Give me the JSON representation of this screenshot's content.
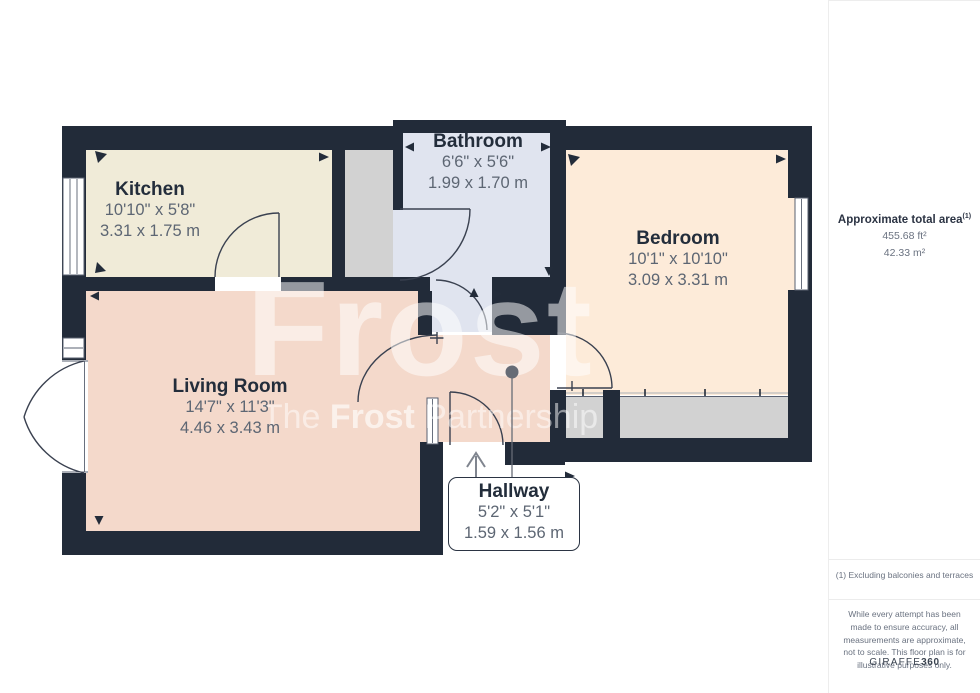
{
  "plan": {
    "watermark": {
      "line1": "Frost",
      "line2_pre": "The ",
      "line2_bold": "Frost",
      "line2_post": " Partnership"
    },
    "rooms": [
      {
        "id": "kitchen",
        "name": "Kitchen",
        "imperial": "10'10\" x 5'8\"",
        "metric": "3.31 x 1.75 m"
      },
      {
        "id": "bathroom",
        "name": "Bathroom",
        "imperial": "6'6\" x 5'6\"",
        "metric": "1.99 x 1.70 m"
      },
      {
        "id": "bedroom",
        "name": "Bedroom",
        "imperial": "10'1\" x 10'10\"",
        "metric": "3.09 x 3.31 m"
      },
      {
        "id": "living",
        "name": "Living Room",
        "imperial": "14'7\" x 11'3\"",
        "metric": "4.46 x 3.43 m"
      },
      {
        "id": "hallway",
        "name": "Hallway",
        "imperial": "5'2\" x 5'1\"",
        "metric": "1.59 x 1.56 m"
      }
    ],
    "colors": {
      "wall": "#222b39",
      "kitchen": "#f0ebd8",
      "living": "#f4d9cb",
      "bedroom": "#fdebd9",
      "bathroom": "#e0e4ef",
      "closet": "#d2d2d2"
    }
  },
  "sidebar": {
    "area_title": "Approximate total area",
    "area_sup": "(1)",
    "area_ft": "455.68 ft²",
    "area_m": "42.33 m²",
    "footnote": "(1) Excluding balconies and terraces",
    "disclaimer": "While every attempt has been made to ensure accuracy, all measurements are approximate, not to scale. This floor plan is for illustrative purposes only.",
    "brand_regular": "GIRAFFE",
    "brand_bold": "360"
  }
}
